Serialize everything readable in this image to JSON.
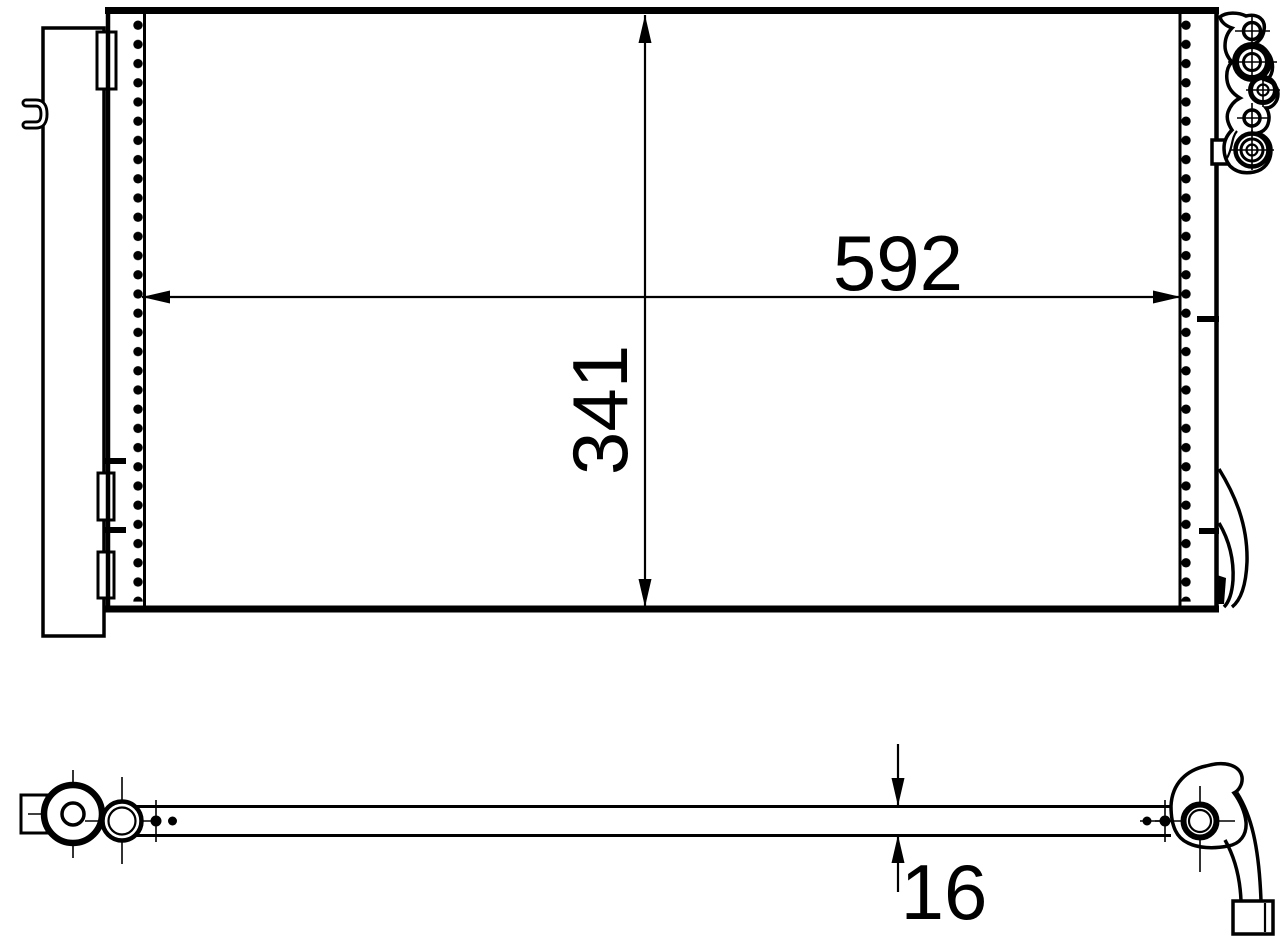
{
  "drawing": {
    "kind": "technical-part-drawing",
    "subject": "air-conditioning condenser with receiver drier",
    "background_color": "#ffffff",
    "line_color": "#000000",
    "views": {
      "front_view": "condenser front view with core, left receiver drier, right port bracket",
      "bottom_view": "condenser bottom profile showing core thickness"
    },
    "dimensions": {
      "core_width": "592",
      "core_height": "341",
      "core_depth": "16"
    }
  }
}
